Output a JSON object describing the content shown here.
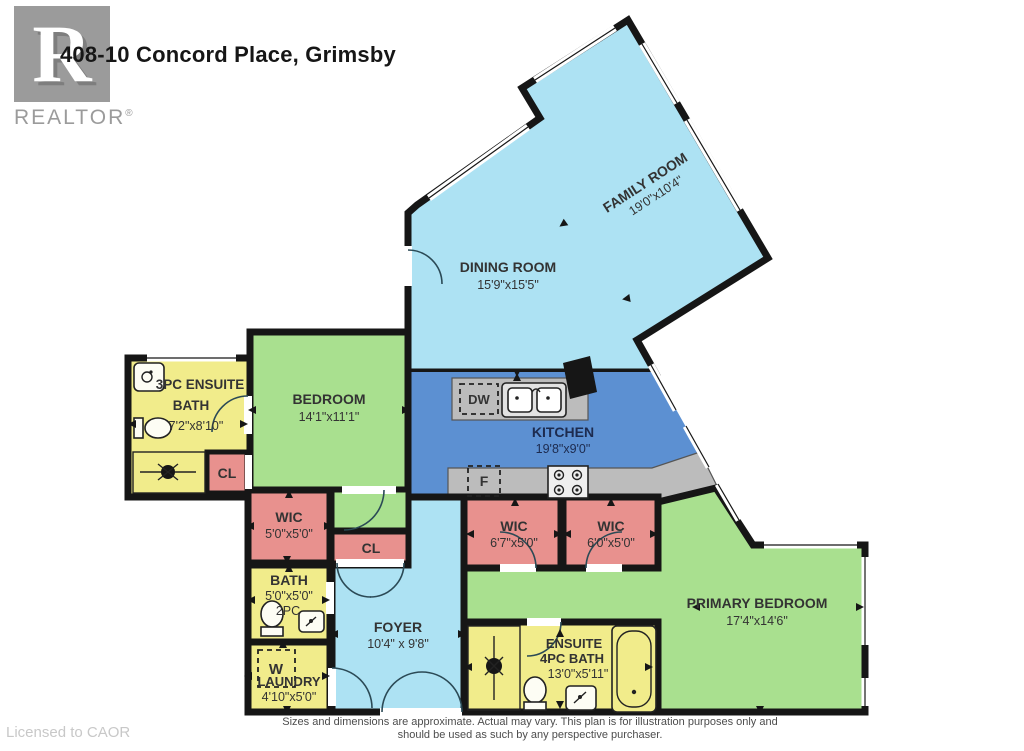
{
  "header": {
    "title": "408-10 Concord Place, Grimsby",
    "logo": {
      "letter": "R",
      "label": "REALTOR",
      "registered": "®"
    }
  },
  "rooms": {
    "family": {
      "name": "FAMILY ROOM",
      "dims": "19'0\"x10'4\""
    },
    "dining": {
      "name": "DINING ROOM",
      "dims": "15'9\"x15'5\""
    },
    "kitchen": {
      "name": "KITCHEN",
      "dims": "19'8\"x9'0\""
    },
    "bedroom": {
      "name": "BEDROOM",
      "dims": "14'1\"x11'1\""
    },
    "ensuite3": {
      "name_line1": "3PC ENSUITE",
      "name_line2": "BATH",
      "dims": "7'2\"x8'10\""
    },
    "closet_bath": {
      "name": "CL"
    },
    "wic_left": {
      "name": "WIC",
      "dims": "5'0\"x5'0\""
    },
    "closet_hall": {
      "name": "CL"
    },
    "bath2pc": {
      "name": "BATH",
      "dims": "5'0\"x5'0\"",
      "type": "2PC"
    },
    "laundry": {
      "name": "LAUNDRY",
      "dims": "4'10\"x5'0\""
    },
    "foyer": {
      "name": "FOYER",
      "dims": "10'4\" x 9'8\""
    },
    "wic1": {
      "name": "WIC",
      "dims": "6'7\"x5'0\""
    },
    "wic2": {
      "name": "WIC",
      "dims": "6'0\"x5'0\""
    },
    "primary": {
      "name": "PRIMARY BEDROOM",
      "dims": "17'4\"x14'6\""
    },
    "ensuite4": {
      "name_line1": "ENSUITE",
      "name_line2": "4PC BATH",
      "dims": "13'0\"x5'11\""
    }
  },
  "appliances": {
    "dishwasher": "DW",
    "fridge": "F",
    "washer": "W"
  },
  "footer": {
    "license": "Licensed to CAOR",
    "disclaimer_line1": "Sizes and dimensions are approximate. Actual may vary. This plan is for illustration purposes only and",
    "disclaimer_line2": "should be used as such by any perspective purchaser."
  },
  "colors": {
    "room_blue": "#ade2f3",
    "kitchen_blue": "#5c90d2",
    "room_green": "#a9e08f",
    "room_pink": "#e8918e",
    "room_yellow": "#f1ec8b",
    "counter_gray": "#bcbcbc",
    "wall_black": "#161616",
    "logo_gray": "#9b9b9b"
  }
}
